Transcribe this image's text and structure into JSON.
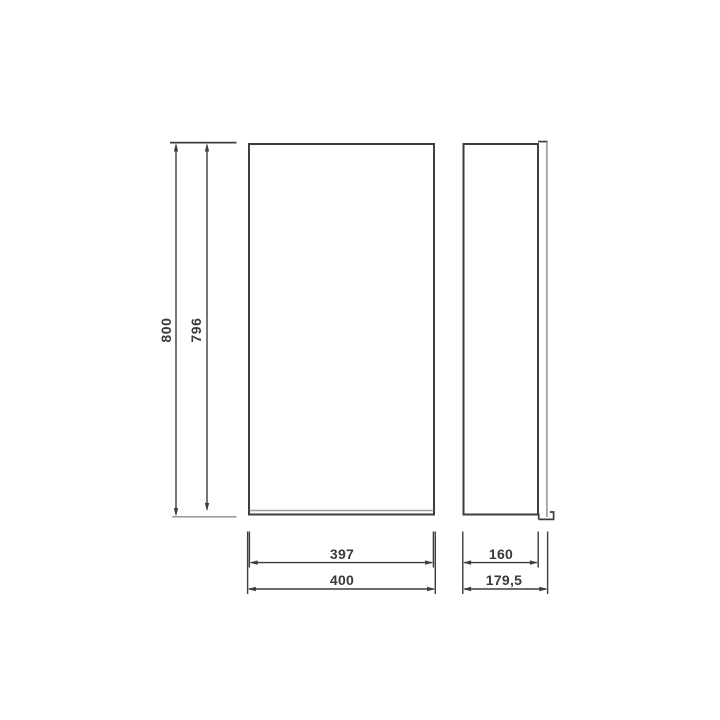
{
  "colors": {
    "background": "#ffffff",
    "line": "#3d3d3d",
    "line-light": "#9c9c9c",
    "line-mid": "#8a8a8a",
    "text": "#3a3a3a"
  },
  "drawing": {
    "front_view": {
      "dim_height_outer": "800",
      "dim_height_inner": "796",
      "dim_width_inner": "397",
      "dim_width_outer": "400"
    },
    "side_view": {
      "dim_depth_body": "160",
      "dim_depth_total": "179,5"
    }
  }
}
